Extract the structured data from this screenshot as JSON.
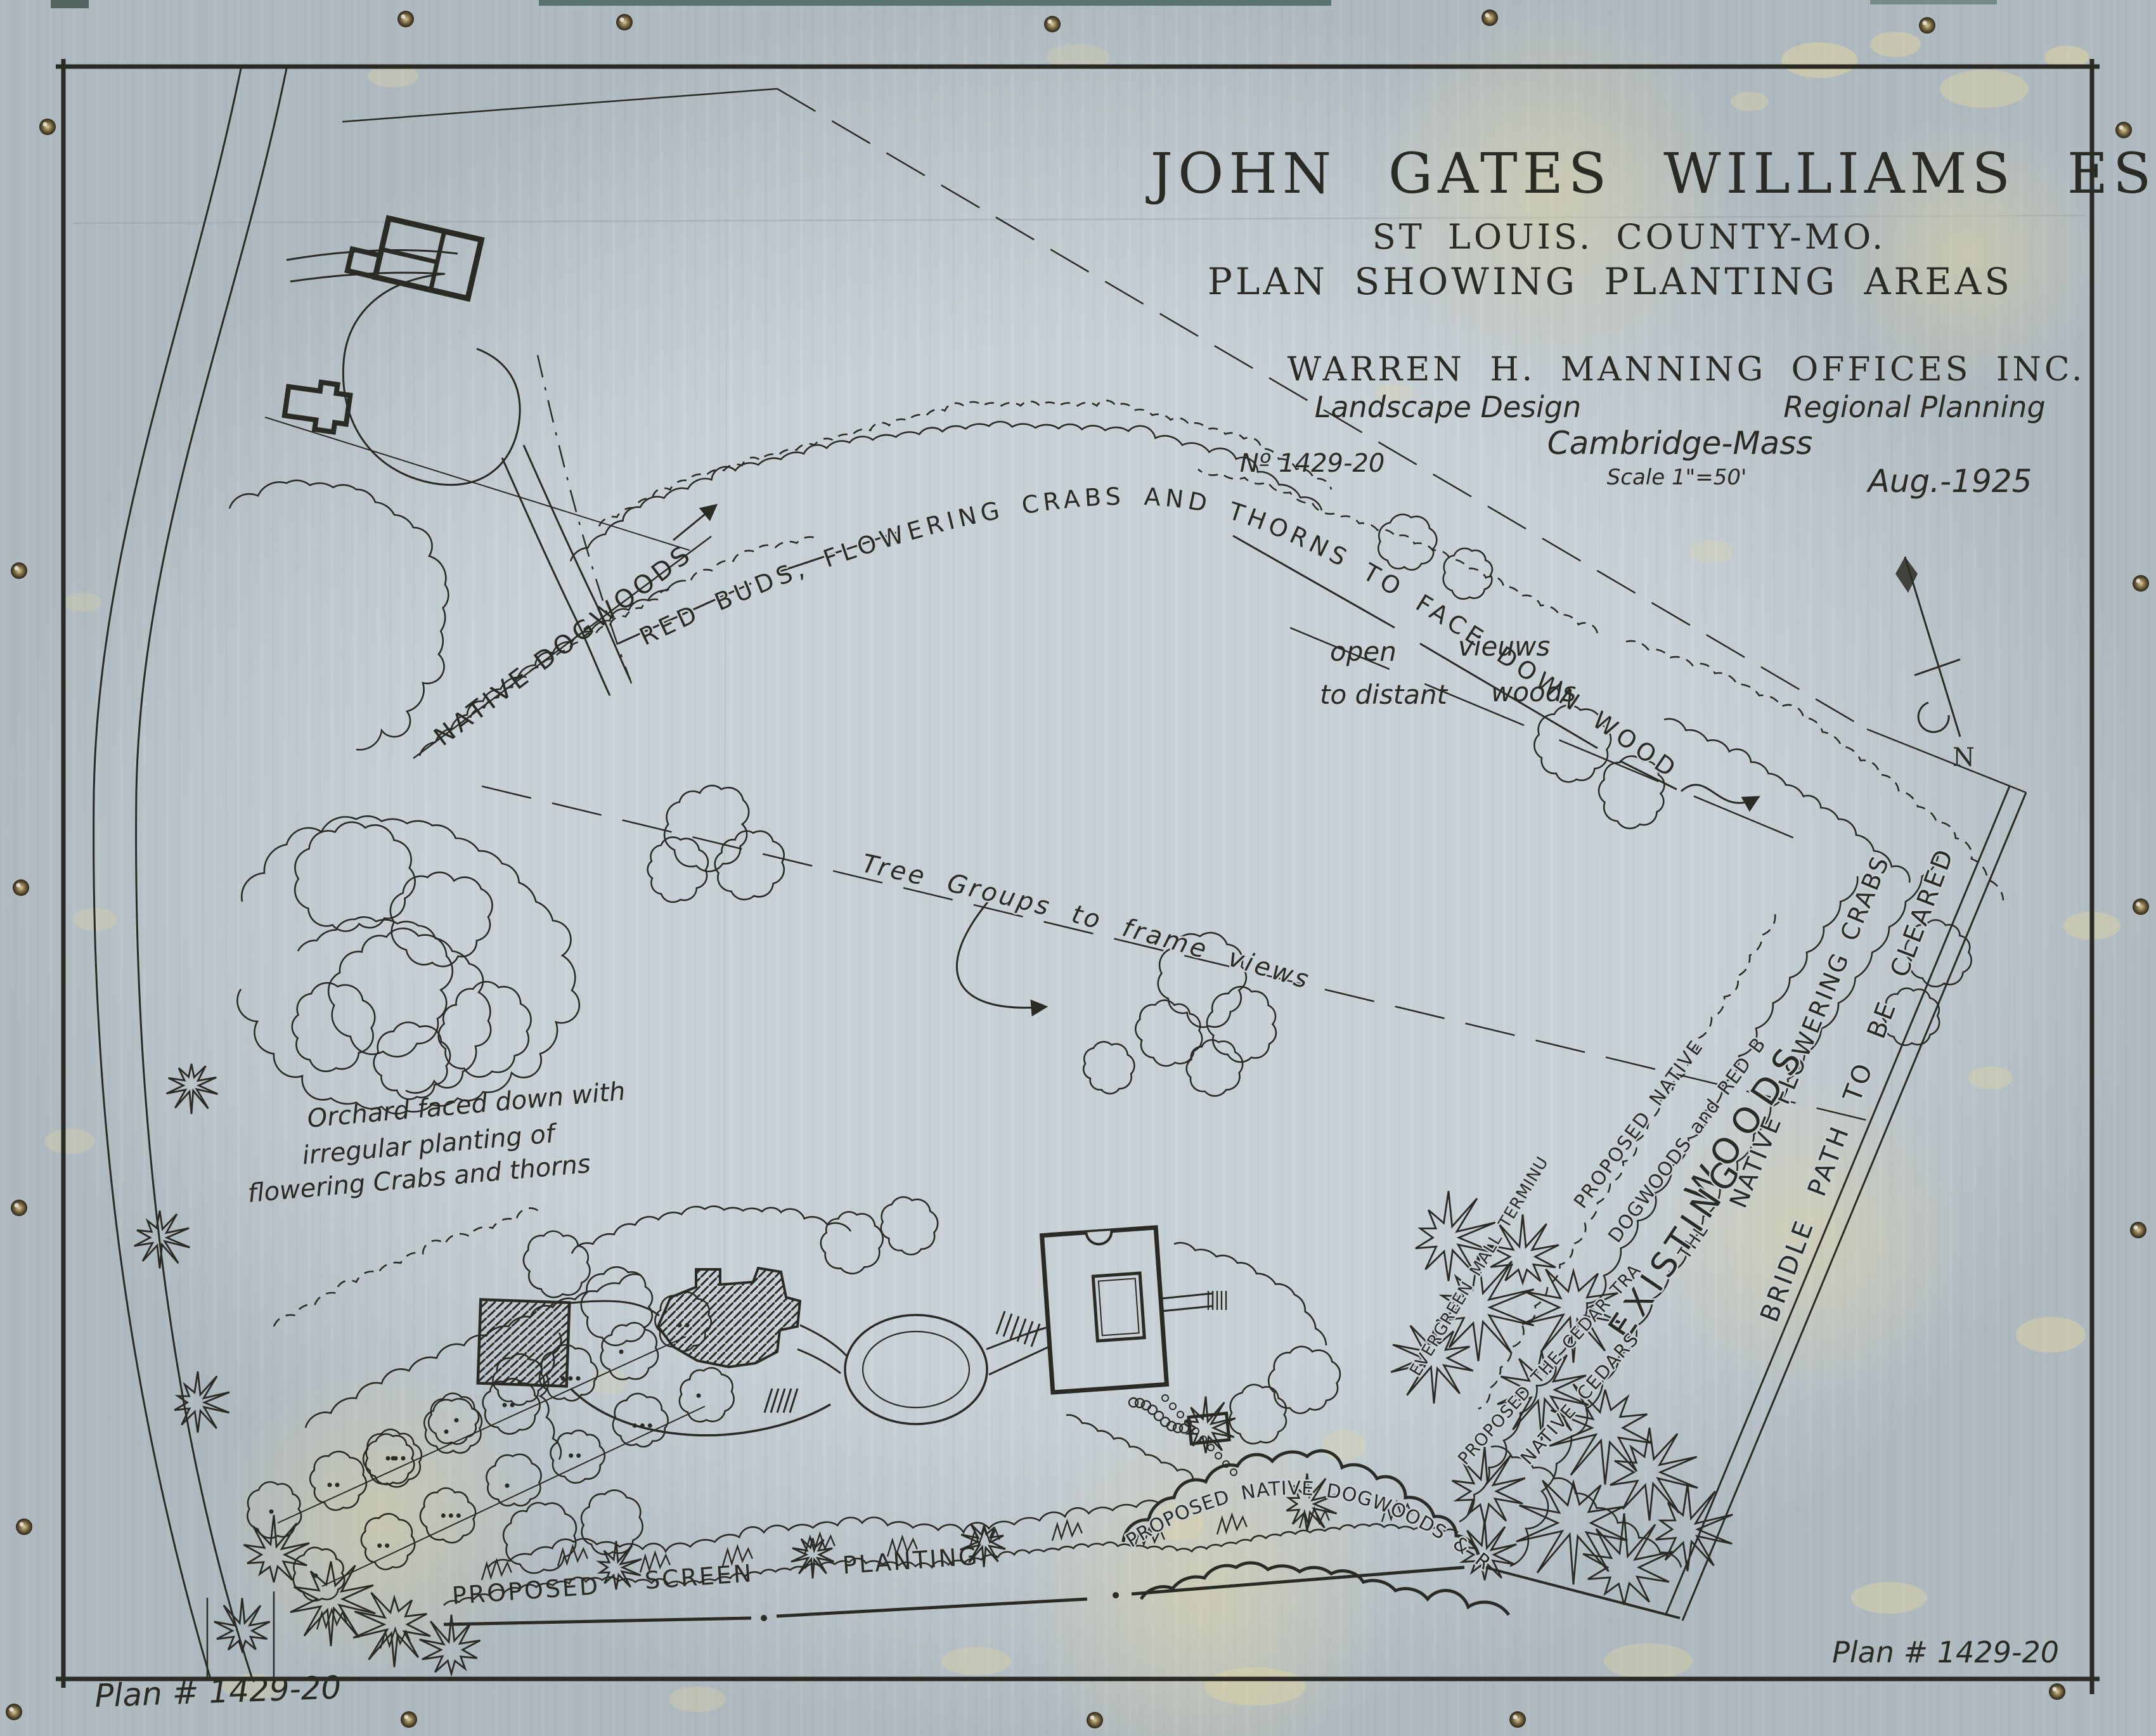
{
  "title": {
    "client": "JOHN GATES WILLIAMS ESQ.",
    "location": "ST LOUIS. COUNTY-MO.",
    "subject": "PLAN SHOWING PLANTING AREAS",
    "firm": "WARREN H. MANNING OFFICES INC.",
    "service_left": "Landscape Design",
    "service_right": "Regional Planning",
    "firm_city": "Cambridge-Mass",
    "plan_no": "Nº 1429-20",
    "scale": "Scale 1\"=50'",
    "date": "Aug.-1925"
  },
  "annotations": {
    "red_buds_band": "RED BUDS, FLOWERING CRABS AND THORNS TO FACE DOWN WOODS",
    "native_dogwoods": "NATIVE DOGWOODS",
    "open_l1a": "open",
    "open_l1b": "vieuws",
    "open_l2a": "to distant",
    "open_l2b": "woods",
    "tree_groups": "Tree Groups to frame views",
    "orchard_l1": "Orchard faced down with",
    "orchard_l2": "irregular planting of",
    "orchard_l3": "flowering Crabs and thorns",
    "native_flowering_crabs": "NATIVE FLOWERING CRABS",
    "bridle_path": "BRIDLE PATH TO BE CLEARED",
    "woods": "WOODS",
    "the": "THE",
    "existing": "EXISTING",
    "proposed_native_l1": "PROPOSED NATIVE",
    "proposed_native_l2": "DOGWOODS and RED BUDS",
    "evergreen_mall": "EVERGREEN MALL TERMINUS",
    "cedar_trail": "PROPOSED THE CEDAR TRAIL",
    "native_cedars": "NATIVE CEDARS",
    "screen_w1": "PROPOSED",
    "screen_w2": "SCREEN",
    "screen_w3": "PLANTING",
    "dogwood_redbud_curve": "PROPOSED NATIVE DOGWOODS & RED BUDS",
    "north": "N"
  },
  "footer": {
    "plan_no_left": "Plan # 1429-20",
    "plan_no_right": "Plan # 1429-20"
  },
  "colors": {
    "paper": "#c7d0d5",
    "ink": "#2b2b26",
    "stain": "#e4d69e",
    "tack": "#6b5a3a"
  }
}
